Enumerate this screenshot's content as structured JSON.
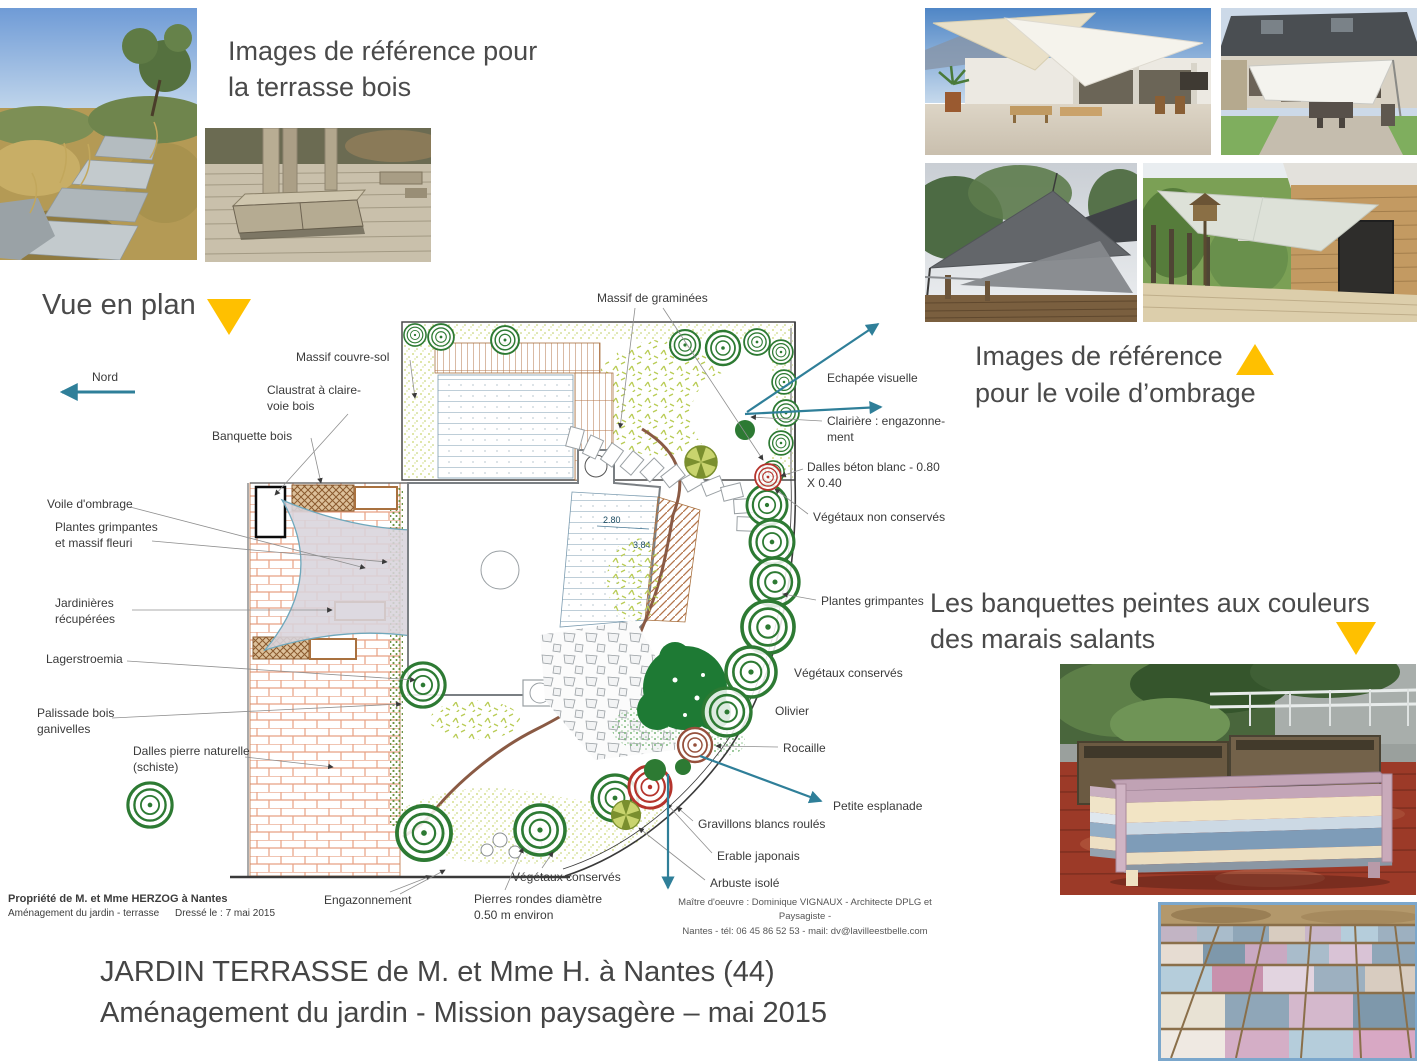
{
  "headings": {
    "terrasse_ref": "Images de référence pour\nla terrasse bois",
    "vue_en_plan": "Vue en plan",
    "voile_ref_line1": "Images de référence",
    "voile_ref_line2": "pour le voile d’ombrage",
    "banquettes": "Les banquettes peintes aux couleurs\ndes marais salants"
  },
  "plan": {
    "dim_width": "2.80",
    "dim_depth": "3.84",
    "labels": {
      "nord": "Nord",
      "massif_graminees": "Massif de graminées",
      "massif_couvre_sol": "Massif couvre-sol",
      "claustrat": "Claustrat à claire-\nvoie bois",
      "banquette_bois": "Banquette bois",
      "voile_ombrage": "Voile d'ombrage",
      "plantes_grimpantes_massif": "Plantes grimpantes\net massif fleuri",
      "jardinieres": "Jardinières\nrécupérées",
      "lagerstroemia": "Lagerstroemia",
      "palissade": "Palissade bois\nganivelles",
      "dalles_pierre": "Dalles pierre naturelle\n(schiste)",
      "echapee": "Echapée visuelle",
      "clairiere": "Clairière : engazonne-\nment",
      "dalles_beton": "Dalles béton blanc - 0.80\nX 0.40",
      "vegetaux_non_conserves": "Végétaux non conservés",
      "plantes_grimpantes": "Plantes grimpantes",
      "vegetaux_conserves": "Végétaux conservés",
      "olivier": "Olivier",
      "rocaille": "Rocaille",
      "petite_esplanade": "Petite esplanade",
      "gravillons": "Gravillons blancs roulés",
      "erable": "Erable japonais",
      "arbuste": "Arbuste isolé",
      "engazonnement": "Engazonnement",
      "vegetaux_conserves_2": "Végétaux conservés",
      "pierres_rondes": "Pierres rondes diamètre\n0.50 m environ"
    }
  },
  "cartouche": {
    "owner": "Propriété de M. et Mme HERZOG à Nantes",
    "project": "Aménagement du jardin - terrasse",
    "date": "Dressé le : 7 mai 2015"
  },
  "credits": "Maître d'oeuvre : Dominique VIGNAUX - Architecte DPLG et Paysagiste -\nNantes - tél: 06 45 86 52 53 - mail: dv@lavilleestbelle.com",
  "footer": {
    "title": "JARDIN TERRASSE de M. et Mme H. à Nantes (44)\nAménagement du jardin - Mission paysagère – mai 2015"
  },
  "colors": {
    "accent_yellow": "#FFC000",
    "arrow_teal": "#2F7F99",
    "text_dark": "#3F3F3F"
  }
}
